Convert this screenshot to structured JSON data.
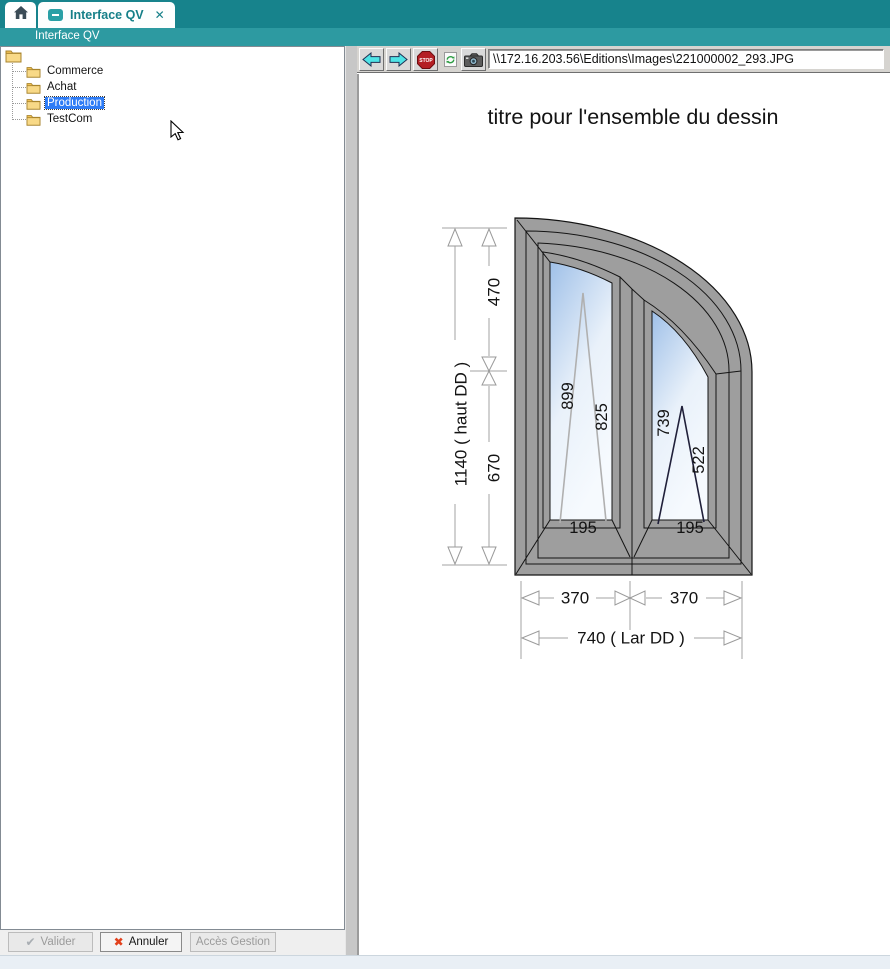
{
  "app": {
    "tab_title": "Interface QV",
    "nav_title": "Interface QV",
    "close_glyph": "✕"
  },
  "tree": {
    "items": [
      {
        "label": "Commerce"
      },
      {
        "label": "Achat"
      },
      {
        "label": "Production",
        "selected": true
      },
      {
        "label": "TestCom"
      }
    ]
  },
  "toolbar": {
    "address": "\\\\172.16.203.56\\Editions\\Images\\221000002_293.JPG",
    "stop_label": "STOP"
  },
  "footer": {
    "valider": "Valider",
    "valider_glyph": "✔",
    "annuler": "Annuler",
    "annuler_glyph": "✖",
    "acces_gestion": "Accès Gestion"
  },
  "drawing": {
    "title": "titre pour l'ensemble du dessin",
    "dim_total_height": "1140 ( haut DD )",
    "dim_seg_top": "470",
    "dim_seg_bottom": "670",
    "dim_width_left": "370",
    "dim_width_right": "370",
    "dim_total_width": "740 ( Lar DD )",
    "pane_left_dim_a": "899",
    "pane_left_dim_b": "825",
    "pane_left_dim_bottom": "195",
    "pane_right_dim_a": "739",
    "pane_right_dim_b": "522",
    "pane_right_dim_bottom": "195"
  },
  "colors": {
    "teal_dark": "#17838c",
    "teal_mid": "#2d9aa1",
    "selection_blue": "#2e7cf6",
    "stop_red": "#b41f24",
    "arrow_cyan": "#4fe3e6",
    "annuler_red": "#e2401c"
  }
}
